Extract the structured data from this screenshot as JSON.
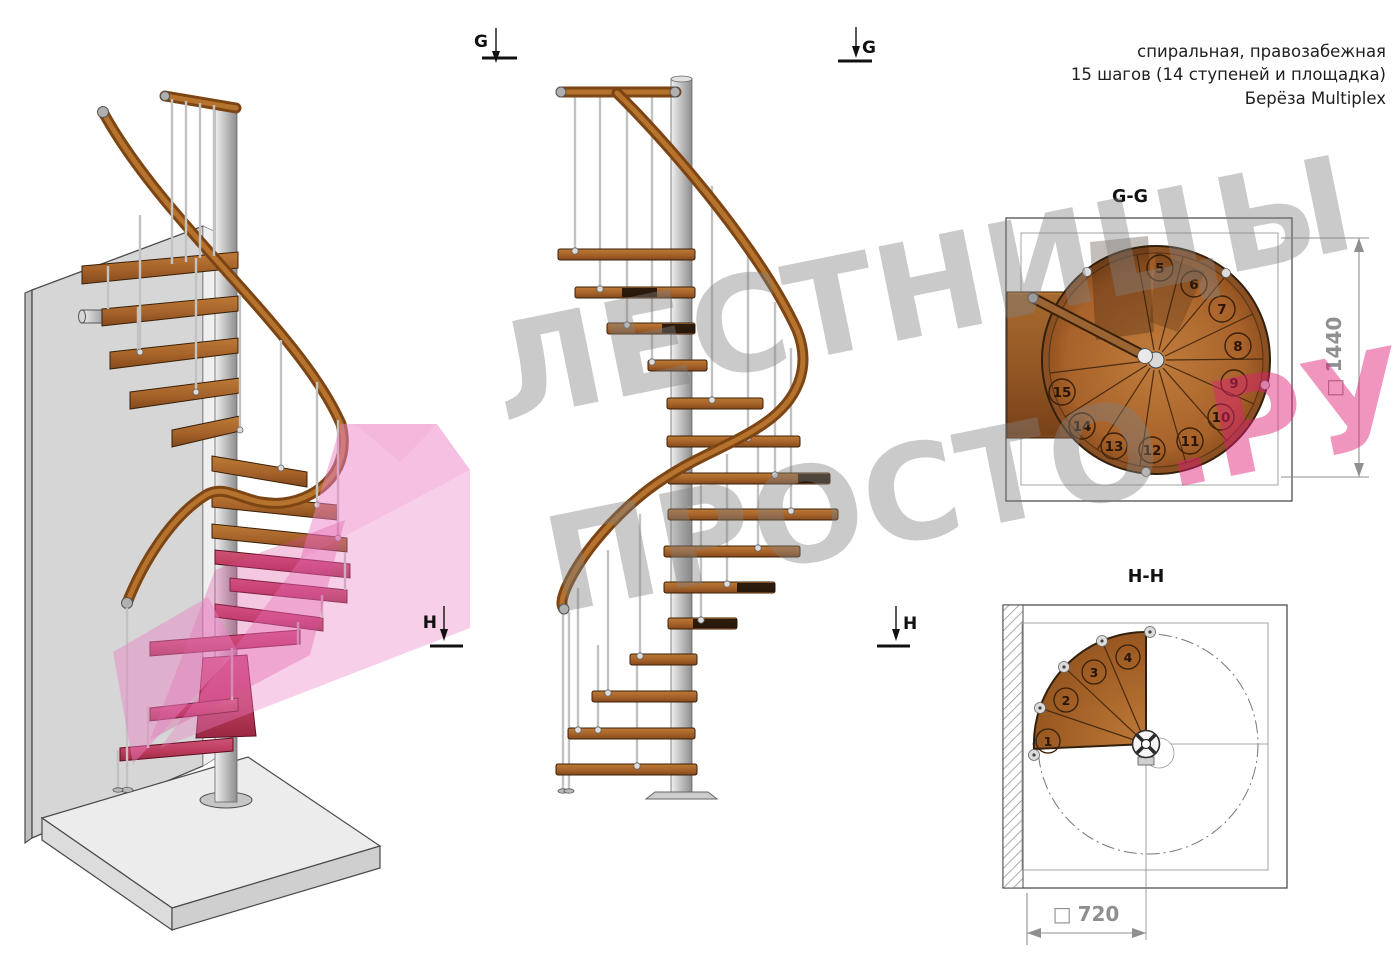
{
  "header": {
    "line1": "спиральная, правозабежная",
    "line2": "15 шагов (14 ступеней и площадка)",
    "line3": "Берёза Multiplex"
  },
  "watermark": {
    "line1": "ЛЕСТНИЦЫ",
    "line2_gray": "ПРОСТО",
    "line2_accent": ".РУ"
  },
  "markers": {
    "g": "G",
    "h": "H"
  },
  "plan_gg": {
    "title": "G-G",
    "square": "□",
    "dimension": "1440",
    "steps": [
      "5",
      "6",
      "7",
      "8",
      "9",
      "10",
      "11",
      "12",
      "13",
      "14",
      "15"
    ]
  },
  "plan_hh": {
    "title": "H-H",
    "square": "□",
    "dimension": "720",
    "steps": [
      "1",
      "2",
      "3",
      "4"
    ]
  },
  "colors": {
    "wood": "#ab6a2e",
    "wood_dark": "#81491a",
    "metal": "#c7c7c7",
    "pink_plane": "#ec82c6",
    "step_highlight": "#c0405e",
    "watermark_gray": "#b9b9b9",
    "watermark_pink": "#e8509a",
    "dim_gray": "#8f8f8f"
  }
}
